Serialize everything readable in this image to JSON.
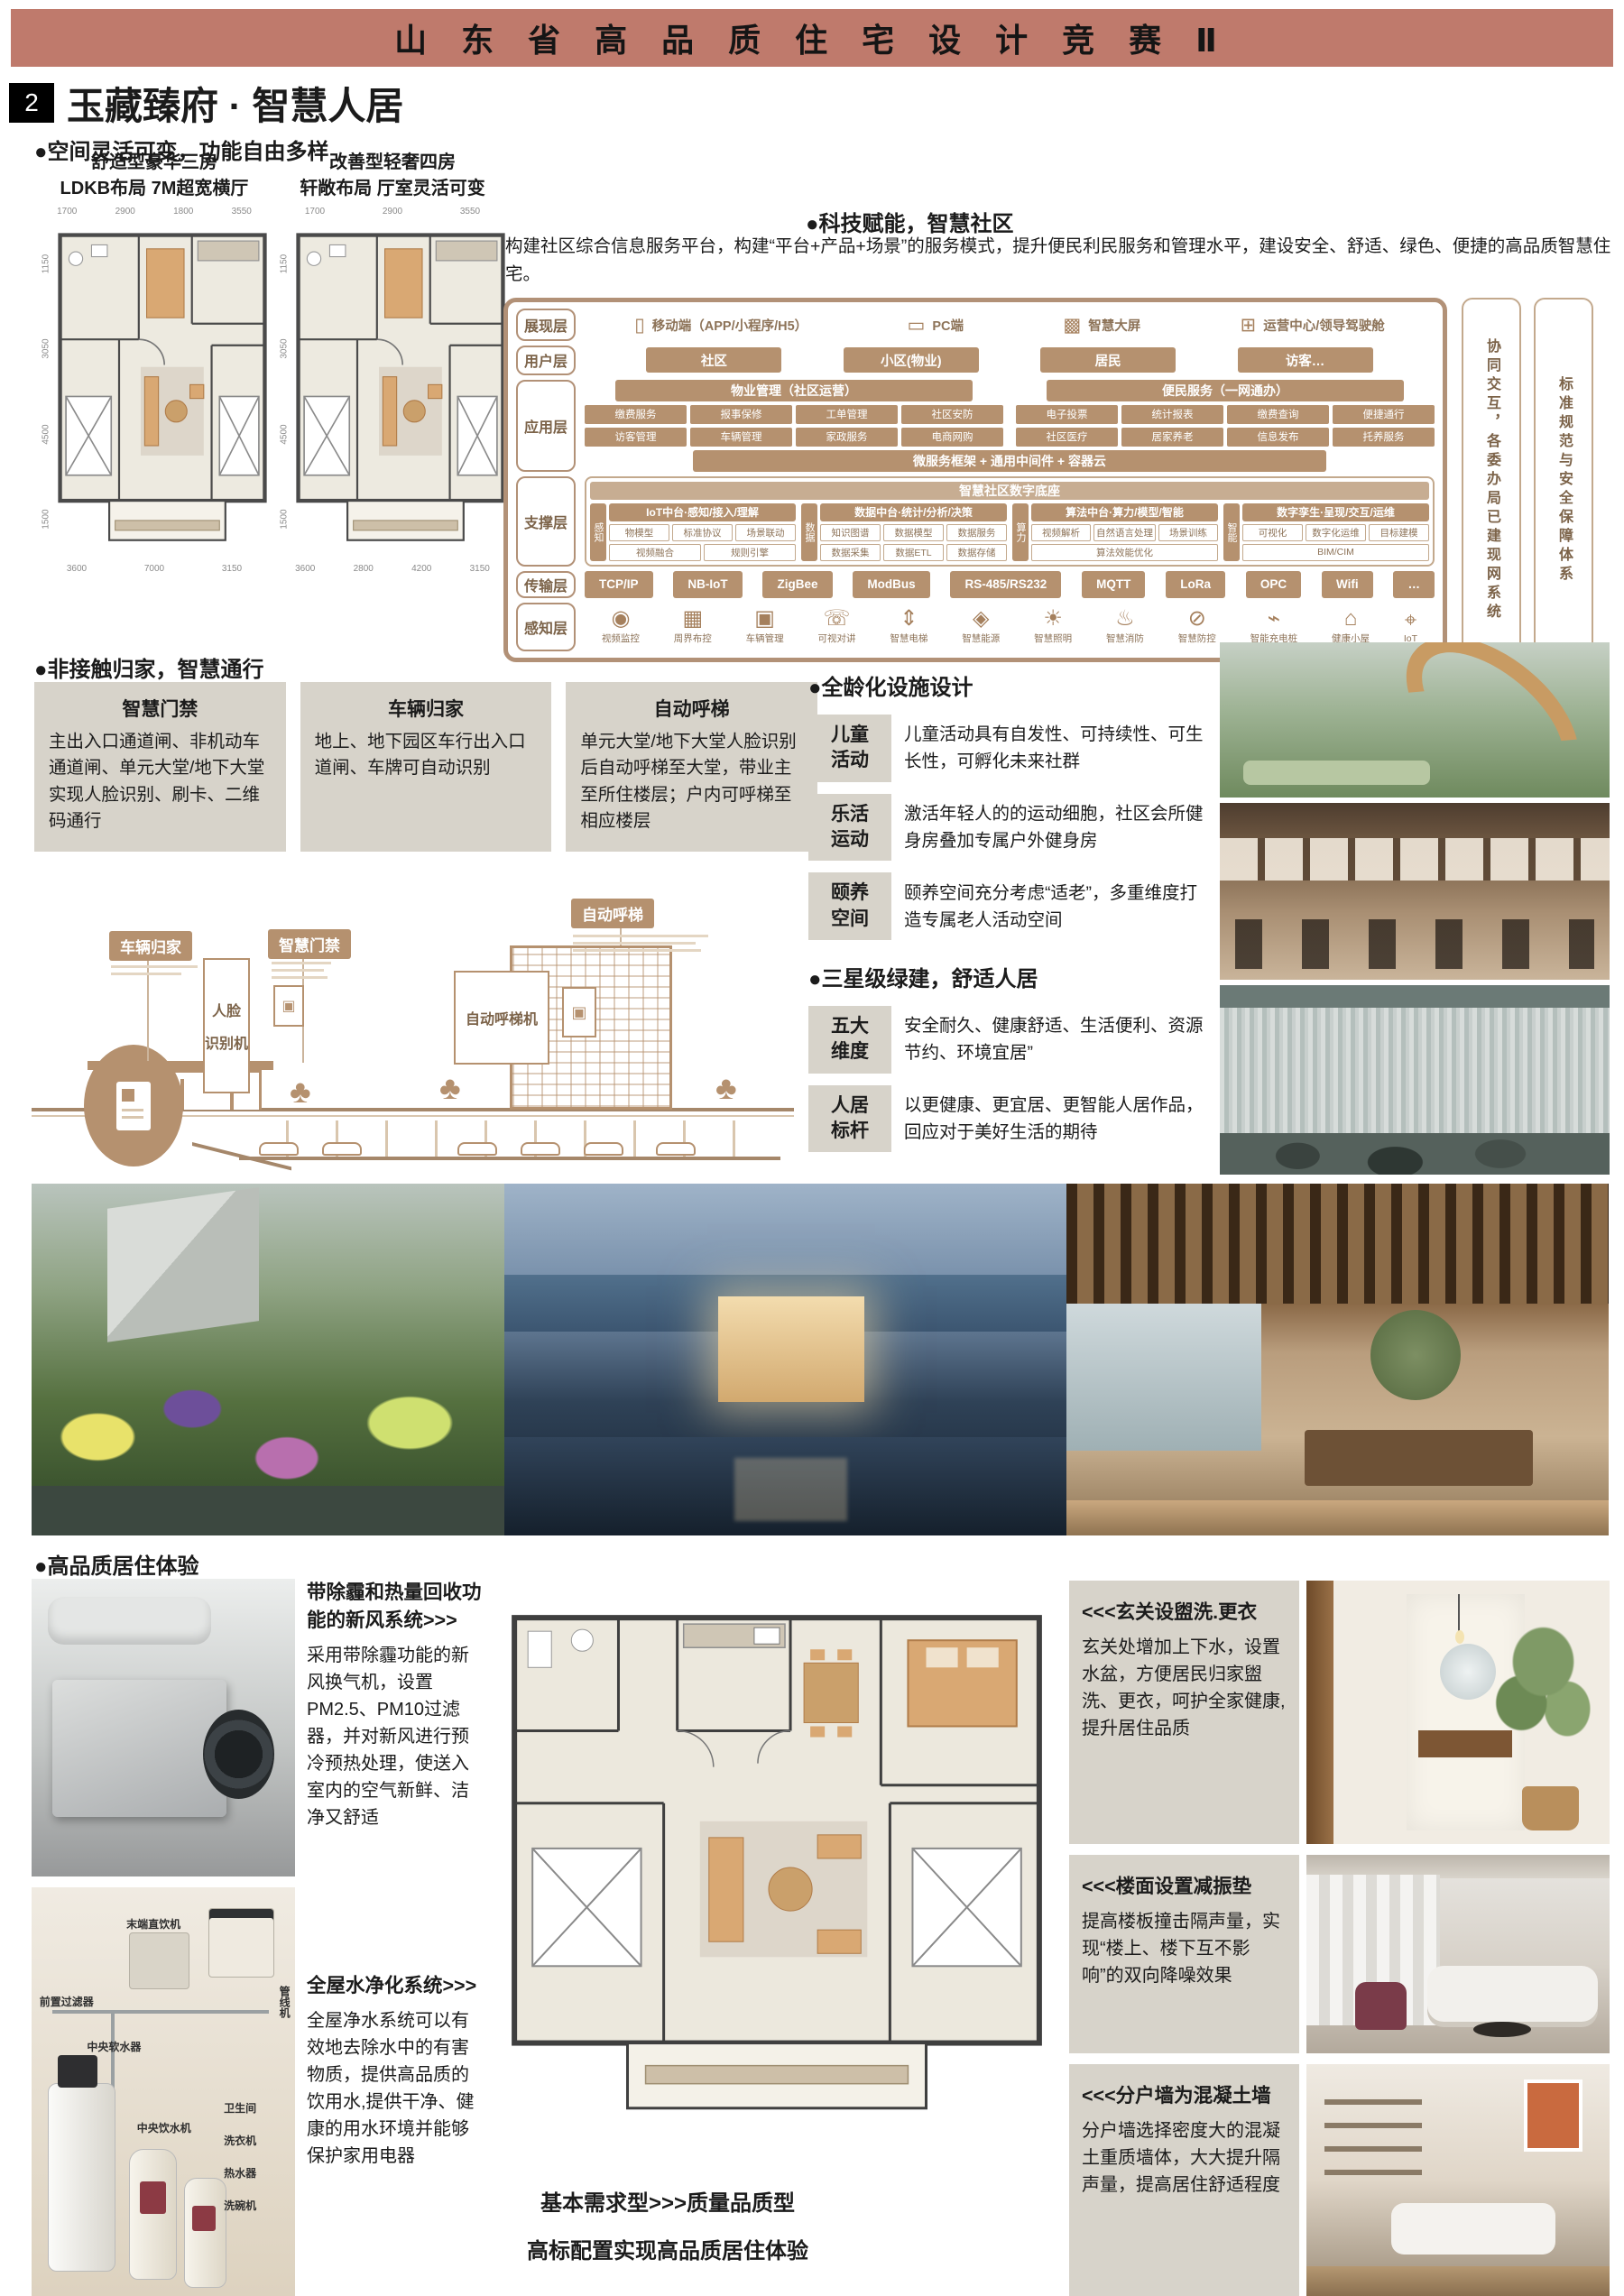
{
  "header": {
    "competition_title": "山 东 省 高 品 质 住 宅 设 计 竞 赛 Ⅱ"
  },
  "section": {
    "number": "2",
    "title": "玉藏臻府 · 智慧人居"
  },
  "flex_space": {
    "heading": "●空间灵活可变，功能自由多样",
    "plans": [
      {
        "caption_line1": "舒适型豪华三房",
        "caption_line2": "LDKB布局  7M超宽横厅",
        "dims_top": [
          "1700",
          "2900",
          "1800",
          "3550"
        ],
        "dims_left": [
          "1150",
          "3050",
          "4500",
          "1500"
        ],
        "dims_bottom": [
          "3600",
          "7000",
          "3150"
        ]
      },
      {
        "caption_line1": "改善型轻奢四房",
        "caption_line2": "轩敞布局  厅室灵活可变",
        "dims_top": [
          "1700",
          "2900",
          "3550"
        ],
        "dims_left": [
          "1150",
          "3050",
          "4500",
          "1500"
        ],
        "dims_bottom": [
          "3600",
          "2800",
          "4200",
          "3150"
        ]
      }
    ]
  },
  "smart_tech": {
    "heading": "●科技赋能，智慧社区",
    "intro": "构建社区综合信息服务平台，构建“平台+产品+场景”的服务模式，提升便民利民服务和管理水平，建设安全、舒适、绿色、便捷的高品质智慧住宅。",
    "presentation": {
      "label": "展现层",
      "items": [
        {
          "icon": "mobile-icon",
          "glyph": "▯",
          "label": "移动端（APP/小程序/H5）"
        },
        {
          "icon": "pc-icon",
          "glyph": "▭",
          "label": "PC端"
        },
        {
          "icon": "big-screen-icon",
          "glyph": "▩",
          "label": "智慧大屏"
        },
        {
          "icon": "ops-center-icon",
          "glyph": "⊞",
          "label": "运营中心/领导驾驶舱"
        }
      ]
    },
    "users": {
      "label": "用户层",
      "items": [
        "社区",
        "小区(物业)",
        "居民",
        "访客…"
      ]
    },
    "app": {
      "label": "应用层",
      "groups": [
        {
          "title": "物业管理（社区运营）",
          "items": [
            "缴费服务",
            "报事保修",
            "工单管理",
            "社区安防",
            "访客管理",
            "车辆管理",
            "家政服务",
            "电商网购"
          ]
        },
        {
          "title": "便民服务（一网通办）",
          "items": [
            "电子投票",
            "统计报表",
            "缴费查询",
            "便捷通行",
            "社区医疗",
            "居家养老",
            "信息发布",
            "托养服务"
          ]
        }
      ],
      "bottom_bar": "微服务框架 + 通用中间件 + 容器云"
    },
    "support": {
      "label": "支撑层",
      "banner": "智慧社区数字底座",
      "groups": [
        {
          "tag": "感知",
          "title": "IoT中台·感知/接入/理解",
          "items": [
            "物模型",
            "标准协议",
            "场景联动",
            "视频融合",
            "规则引擎"
          ]
        },
        {
          "tag": "数据",
          "title": "数据中台·统计/分析/决策",
          "items": [
            "知识图谱",
            "数据模型",
            "数据服务",
            "数据采集",
            "数据ETL",
            "数据存储"
          ]
        },
        {
          "tag": "算力",
          "title": "算法中台·算力/模型/智能",
          "items": [
            "视频解析",
            "自然语言处理",
            "场景训练",
            "算法效能优化"
          ]
        },
        {
          "tag": "智能",
          "title": "数字孪生·呈现/交互/运维",
          "items": [
            "可视化",
            "数字化运维",
            "目标建模",
            "BIM/CIM"
          ]
        }
      ]
    },
    "transport": {
      "label": "传输层",
      "items": [
        "TCP/IP",
        "NB-IoT",
        "ZigBee",
        "ModBus",
        "RS-485/RS232",
        "MQTT",
        "LoRa",
        "OPC",
        "Wifi",
        "…"
      ]
    },
    "perception": {
      "label": "感知层",
      "items": [
        {
          "icon": "camera-icon",
          "glyph": "◉",
          "label": "视频监控"
        },
        {
          "icon": "perimeter-icon",
          "glyph": "▦",
          "label": "周界布控"
        },
        {
          "icon": "vehicle-icon",
          "glyph": "▣",
          "label": "车辆管理"
        },
        {
          "icon": "intercom-icon",
          "glyph": "☏",
          "label": "可视对讲"
        },
        {
          "icon": "elevator-icon",
          "glyph": "⇕",
          "label": "智慧电梯"
        },
        {
          "icon": "energy-icon",
          "glyph": "◈",
          "label": "智慧能源"
        },
        {
          "icon": "lighting-icon",
          "glyph": "☀",
          "label": "智慧照明"
        },
        {
          "icon": "fire-hydrant-icon",
          "glyph": "♨",
          "label": "智慧消防"
        },
        {
          "icon": "security-icon",
          "glyph": "⊘",
          "label": "智慧防控"
        },
        {
          "icon": "charging-pile-icon",
          "glyph": "⌁",
          "label": "智能充电桩"
        },
        {
          "icon": "health-hut-icon",
          "glyph": "⌂",
          "label": "健康小屋"
        },
        {
          "icon": "iot-icon",
          "glyph": "⌖",
          "label": "IoT"
        }
      ]
    },
    "side_bars": [
      "协同交互，各委办局已建现网系统",
      "标准规范与安全保障体系"
    ]
  },
  "access": {
    "heading": "●非接触归家，智慧通行",
    "boxes": [
      {
        "title": "智慧门禁",
        "body": "主出入口通道闸、非机动车通道闸、单元大堂/地下大堂实现人脸识别、刷卡、二维码通行"
      },
      {
        "title": "车辆归家",
        "body": "地上、地下园区车行出入口道闸、车牌可自动识别"
      },
      {
        "title": "自动呼梯",
        "body": "单元大堂/地下大堂人脸识别后自动呼梯至大堂，带业主至所住楼层；户内可呼梯至相应楼层"
      }
    ]
  },
  "illustration": {
    "labels": {
      "car_home": "车辆归家",
      "door_access": "智慧门禁",
      "face_line1": "人脸",
      "face_line2": "识别机",
      "auto_call": "自动呼梯",
      "call_machine": "自动呼梯机"
    },
    "panel_glyph": "▣",
    "tree_glyph": "♣"
  },
  "all_age": {
    "heading": "●全龄化设施设计",
    "rows": [
      {
        "tag_line1": "儿童",
        "tag_line2": "活动",
        "text": "儿童活动具有自发性、可持续性、可生长性，可孵化未来社群"
      },
      {
        "tag_line1": "乐活",
        "tag_line2": "运动",
        "text": "激活年轻人的的运动细胞，社区会所健身房叠加专属户外健身房"
      },
      {
        "tag_line1": "颐养",
        "tag_line2": "空间",
        "text": "颐养空间充分考虑“适老”，多重维度打造专属老人活动空间"
      }
    ]
  },
  "green": {
    "heading": "●三星级绿建，舒适人居",
    "rows": [
      {
        "tag_line1": "五大",
        "tag_line2": "维度",
        "text": "安全耐久、健康舒适、生活便利、资源节约、环境宜居”"
      },
      {
        "tag_line1": "人居",
        "tag_line2": "标杆",
        "text": "以更健康、更宜居、更智能人居作品，回应对于美好生活的期待"
      }
    ]
  },
  "quality": {
    "heading": "●高品质居住体验",
    "left_blocks": [
      {
        "title": "带除霾和热量回收功能的新风系统>>>",
        "body": "采用带除霾功能的新风换气机，设置PM2.5、PM10过滤器，并对新风进行预冷预热处理，使送入室内的空气新鲜、洁净又舒适"
      },
      {
        "title": "全屋水净化系统>>>",
        "body": "全屋净水系统可以有效地去除水中的有害物质，提供高品质的饮用水,提供干净、健康的用水环境并能够保护家用电器"
      }
    ],
    "water_labels": [
      "前置过滤器",
      "末端直饮机",
      "管线机",
      "中央软水器",
      "中央饮水机",
      "卫生间",
      "洗衣机",
      "热水器",
      "洗碗机"
    ],
    "plan_caption_line1": "基本需求型>>>质量品质型",
    "plan_caption_line2": "高标配置实现高品质居住体验",
    "right_blocks": [
      {
        "title": "<<<玄关设盥洗.更衣",
        "body": "玄关处增加上下水，设置水盆，方便居民归家盥洗、更衣，呵护全家健康,提升居住品质"
      },
      {
        "title": "<<<楼面设置减振垫",
        "body": "提高楼板撞击隔声量，实现“楼上、楼下互不影响”的双向降噪效果"
      },
      {
        "title": "<<<分户墙为混凝土墙",
        "body": "分户墙选择密度大的混凝土重质墙体，大大提升隔声量，提高居住舒适程度"
      }
    ]
  }
}
